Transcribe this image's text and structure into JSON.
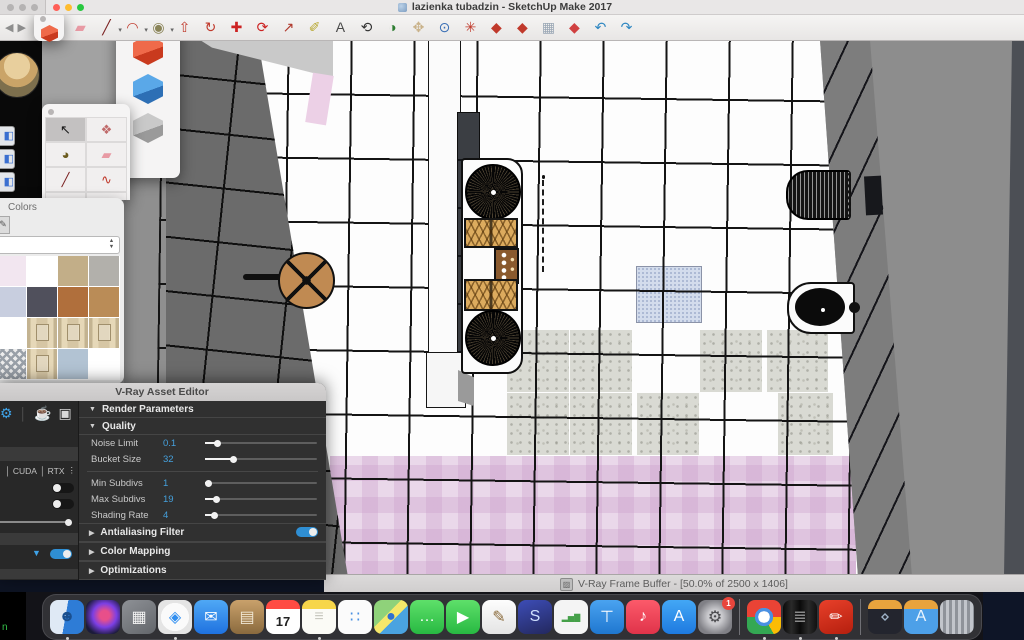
{
  "window": {
    "title": "lazienka tubadzin - SketchUp Make 2017"
  },
  "background_text": "n",
  "toolbar": {
    "nav": [
      {
        "name": "back-icon",
        "glyph": "◀"
      },
      {
        "name": "forward-icon",
        "glyph": "▶"
      }
    ],
    "icons": [
      {
        "name": "eraser-icon",
        "glyph": "▰",
        "color": "#e89aa4"
      },
      {
        "name": "line-tool-icon",
        "glyph": "╱",
        "color": "#7a1f1f",
        "dropdown": true
      },
      {
        "name": "arc-tool-icon",
        "glyph": "◠",
        "color": "#c0392b",
        "dropdown": true
      },
      {
        "name": "circle-tool-icon",
        "glyph": "◉",
        "color": "#8a8458",
        "dropdown": true
      },
      {
        "name": "pushpull-icon",
        "glyph": "⇧",
        "color": "#c0392b"
      },
      {
        "name": "followme-icon",
        "glyph": "↻",
        "color": "#c0392b"
      },
      {
        "name": "move-icon",
        "glyph": "✚",
        "color": "#cc2222"
      },
      {
        "name": "rotate-icon",
        "glyph": "⟳",
        "color": "#cc2222"
      },
      {
        "name": "scale-icon",
        "glyph": "↗",
        "color": "#b03a2e"
      },
      {
        "name": "tape-measure-icon",
        "glyph": "✐",
        "color": "#b8a832"
      },
      {
        "name": "text-tool-icon",
        "glyph": "A",
        "color": "#4a4a4a"
      },
      {
        "name": "orbit-icon",
        "glyph": "⟲",
        "color": "#333333"
      },
      {
        "name": "look-around-icon",
        "glyph": "◑",
        "color": "#2e7d32"
      },
      {
        "name": "pan-icon",
        "glyph": "✥",
        "color": "#c9b28a"
      },
      {
        "name": "zoom-icon",
        "glyph": "⊙",
        "color": "#3b6fb5"
      },
      {
        "name": "zoom-extents-icon",
        "glyph": "✳",
        "color": "#c0392b"
      },
      {
        "name": "vray-render-icon",
        "glyph": "◆",
        "color": "#c0392b"
      },
      {
        "name": "vray-interactive-icon",
        "glyph": "◆",
        "color": "#c0392b"
      },
      {
        "name": "vray-buffer-icon",
        "glyph": "▦",
        "color": "#9aa7b5"
      },
      {
        "name": "vray-gpu-icon",
        "glyph": "◆",
        "color": "#d04040"
      },
      {
        "name": "undo-icon",
        "glyph": "↶",
        "color": "#2e86c1"
      },
      {
        "name": "redo-icon",
        "glyph": "↷",
        "color": "#2e86c1"
      }
    ]
  },
  "cube_palette": {
    "icons": [
      {
        "name": "red-box-icon",
        "color1": "#ef6a4a",
        "color2": "#c93a1e"
      },
      {
        "name": "blue-box-icon",
        "color1": "#5aa8e8",
        "color2": "#2d6fb5"
      },
      {
        "name": "gray-box-icon",
        "color1": "#c9c9c9",
        "color2": "#9a9a9a"
      }
    ]
  },
  "mini_window": {
    "icon": {
      "name": "red-box-icon",
      "color1": "#ef6a4a",
      "color2": "#c93a1e"
    }
  },
  "tool_palette": {
    "tools": [
      {
        "name": "select-tool-icon",
        "glyph": "↖",
        "color": "#1a1a1a",
        "active": true
      },
      {
        "name": "make-component-icon",
        "glyph": "❖",
        "color": "#c06a6a"
      },
      {
        "name": "paint-bucket-icon",
        "glyph": "◕",
        "color": "#6b5b1e"
      },
      {
        "name": "eraser-tool-icon",
        "glyph": "▰",
        "color": "#e89aa4"
      },
      {
        "name": "line-icon",
        "glyph": "╱",
        "color": "#7a1f1f"
      },
      {
        "name": "freehand-icon",
        "glyph": "∿",
        "color": "#c0392b"
      },
      {
        "name": "rectangle-icon",
        "glyph": "▭",
        "color": "#8a6a5a"
      },
      {
        "name": "rotated-rectangle-icon",
        "glyph": "▱",
        "color": "#a34a3a"
      }
    ]
  },
  "side_strip": {
    "icons": [
      {
        "name": "side-tool-icon-1",
        "glyph": "◧"
      },
      {
        "name": "side-tool-icon-2",
        "glyph": "◧"
      },
      {
        "name": "side-tool-icon-3",
        "glyph": "◧"
      }
    ]
  },
  "colors_panel": {
    "title": "Colors",
    "brush_icon": {
      "name": "brush-icon",
      "glyph": "✎"
    },
    "swatches": [
      {
        "name": "swatch-pale-pink",
        "type": "color",
        "value": "#f2e6f0"
      },
      {
        "name": "swatch-white",
        "type": "color",
        "value": "#ffffff"
      },
      {
        "name": "swatch-tan",
        "type": "color",
        "value": "#c2ae88"
      },
      {
        "name": "swatch-gray",
        "type": "color",
        "value": "#b2b0ab"
      },
      {
        "name": "swatch-periwinkle",
        "type": "color",
        "value": "#c8cedf"
      },
      {
        "name": "swatch-charcoal",
        "type": "color",
        "value": "#50505c"
      },
      {
        "name": "swatch-wood",
        "type": "color",
        "value": "#b06f3c"
      },
      {
        "name": "swatch-camel",
        "type": "color",
        "value": "#ba8c57"
      },
      {
        "name": "swatch-white-2",
        "type": "color",
        "value": "#ffffff"
      },
      {
        "name": "swatch-paper-roll-1",
        "type": "roll"
      },
      {
        "name": "swatch-paper-roll-2",
        "type": "roll"
      },
      {
        "name": "swatch-paper-roll-3",
        "type": "roll"
      },
      {
        "name": "swatch-pattern-tile",
        "type": "pattern"
      },
      {
        "name": "swatch-paper-roll-4",
        "type": "roll"
      },
      {
        "name": "swatch-blue-gray",
        "type": "color",
        "value": "#b2c3d3"
      },
      {
        "name": "swatch-white-3",
        "type": "color",
        "value": "#ffffff"
      }
    ]
  },
  "vray": {
    "title": "V-Ray Asset Editor",
    "left_icons": [
      {
        "name": "settings-icon",
        "glyph": "⚙",
        "color": "#3fa3e8"
      },
      {
        "name": "render-teapot-icon",
        "glyph": "☕",
        "color": "#d8d8d8"
      },
      {
        "name": "frame-buffer-icon",
        "glyph": "▣",
        "color": "#d8d8d8"
      }
    ],
    "device_labels": [
      "CUDA",
      "RTX"
    ],
    "sections": {
      "render_parameters": "Render Parameters",
      "quality": "Quality"
    },
    "params": [
      {
        "label": "Noise Limit",
        "value": "0.1",
        "fill": 11
      },
      {
        "label": "Bucket Size",
        "value": "32",
        "fill": 25
      },
      {
        "label": "Min Subdivs",
        "value": "1",
        "fill": 3,
        "divider_before": true
      },
      {
        "label": "Max Subdivs",
        "value": "19",
        "fill": 10
      },
      {
        "label": "Shading Rate",
        "value": "4",
        "fill": 8
      }
    ],
    "collapsed_sections": [
      {
        "label": "Antialiasing Filter",
        "toggle": true,
        "toggle_on": true
      },
      {
        "label": "Color Mapping"
      },
      {
        "label": "Optimizations"
      }
    ],
    "accent_blue": "#45a0dc"
  },
  "statusbar": {
    "icon": {
      "name": "vfb-icon",
      "glyph": "▨"
    },
    "text": "V-Ray Frame Buffer - [50.0% of 2500 x 1406]"
  },
  "dock": {
    "items": [
      {
        "name": "finder-icon",
        "glyph": "☻",
        "color": "#1a4f8f",
        "bg": "linear-gradient(100deg,#dfe9f5 46%,#2e7cd6 46%)",
        "running": true
      },
      {
        "name": "siri-icon",
        "glyph": "",
        "color": "#fff",
        "bg": "radial-gradient(circle at 55% 45%,#e84f8a 0 18%,#7b3fe4 45%,#1b1b3a 78%)"
      },
      {
        "name": "launchpad-icon",
        "glyph": "▦",
        "color": "#f3f3f3",
        "bg": "linear-gradient(145deg,#8e9196,#63666b)"
      },
      {
        "name": "safari-icon",
        "glyph": "◈",
        "color": "#2f8ef0",
        "bg": "radial-gradient(circle,#fafafa 58%,#e4e4e4 59%)",
        "running": true
      },
      {
        "name": "mail-icon",
        "glyph": "✉",
        "color": "#ffffff",
        "bg": "linear-gradient(180deg,#4fa8f5,#1f72e0)"
      },
      {
        "name": "contacts-icon",
        "glyph": "▤",
        "color": "#f0e6d2",
        "bg": "linear-gradient(180deg,#c9a16b,#8a6a3e)"
      },
      {
        "name": "calendar-icon",
        "day": "17"
      },
      {
        "name": "notes-icon",
        "glyph": "≡",
        "color": "#c9c9c0",
        "bg": "linear-gradient(180deg,#f7d64a 0 26%,#fbfbf6 26%)",
        "running": true
      },
      {
        "name": "reminders-icon",
        "glyph": "∷",
        "color": "#4a90e2",
        "bg": "#fbfbfb"
      },
      {
        "name": "maps-icon",
        "glyph": "●",
        "color": "#2f6fd0",
        "bg": "linear-gradient(135deg,#8fd27a 0 40%,#f5e76a 40% 58%,#4aa3e0 58%)"
      },
      {
        "name": "messages-icon",
        "glyph": "…",
        "color": "#ffffff",
        "bg": "linear-gradient(180deg,#5ee06a,#28b942)"
      },
      {
        "name": "facetime-icon",
        "glyph": "▶",
        "color": "#ffffff",
        "bg": "linear-gradient(180deg,#5ee06a,#28b942)"
      },
      {
        "name": "textedit-icon",
        "glyph": "✎",
        "color": "#8a6a3a",
        "bg": "linear-gradient(180deg,#fdfdfd,#e4e4e4)"
      },
      {
        "name": "s-app-icon",
        "glyph": "S",
        "color": "#cfe0ff",
        "bg": "linear-gradient(160deg,#3d4db7,#23285e)"
      },
      {
        "name": "numbers-icon",
        "glyph": "▂▅▇",
        "color": "#45a049",
        "bg": "#f4f4f4",
        "small": true
      },
      {
        "name": "keynote-icon",
        "glyph": "⊤",
        "color": "#ffffff",
        "bg": "linear-gradient(180deg,#4aa3f0,#1f77d0)"
      },
      {
        "name": "music-icon",
        "glyph": "♪",
        "color": "#ffffff",
        "bg": "linear-gradient(180deg,#fc5a6a,#e0334a)"
      },
      {
        "name": "app-store-icon",
        "glyph": "A",
        "color": "#ffffff",
        "bg": "linear-gradient(180deg,#43a7f5,#1e7ae0)"
      },
      {
        "name": "system-preferences-icon",
        "glyph": "⚙",
        "color": "#4a4a4e",
        "bg": "radial-gradient(circle,#cacace 30%,#808086 72%)",
        "badge": "1"
      },
      {
        "type": "sep"
      },
      {
        "name": "chrome-icon",
        "glyph": "",
        "color": "#fff",
        "bg": "radial-gradient(circle at 50% 50%,#fff 0 24%,#4a90e2 24% 38%,transparent 38%),conic-gradient(from -30deg,#ea4335 0 120deg,#fbbc05 120deg 180deg,#34a853 180deg 300deg,#ea4335 300deg)",
        "running": true
      },
      {
        "name": "dark-utility-app-icon",
        "glyph": "≣",
        "color": "#8a8a8a",
        "bg": "linear-gradient(90deg,#0a0a0a,#2a2a2a 25%,#0a0a0a 50%,#2a2a2a 75%,#111)",
        "running": true
      },
      {
        "name": "sketchup-icon",
        "glyph": "✏",
        "color": "#ffffff",
        "bg": "linear-gradient(160deg,#e8402a,#b51f0e)",
        "running": true
      },
      {
        "type": "sep"
      },
      {
        "name": "downloads-folder-icon",
        "glyph": "⋄",
        "color": "#9fb3c8",
        "bg": "linear-gradient(180deg,#e8a33d 0 26%,#23252e 26%)"
      },
      {
        "name": "applications-folder-icon",
        "glyph": "A",
        "color": "#eaf4fd",
        "bg": "linear-gradient(180deg,#e8a33d 0 26%,#4da0e8 26%)"
      },
      {
        "name": "trash-icon",
        "glyph": "",
        "color": "#fff",
        "bg": "repeating-linear-gradient(90deg,#c2c5cb 0 3px,#8f939a 3px 6px)"
      }
    ]
  },
  "scene": {
    "colors": {
      "wall_gray": "#6b6b6b",
      "right_wall_gray": "#8d8d8d",
      "floor_white": "#fdfdfd",
      "pink_tile": "#ead8ea",
      "terrazzo_tile": "#d9dad3",
      "blue_tile": "#d3dcec",
      "wood": "#c08a52",
      "basket_wicker": "#dcab5e"
    }
  }
}
